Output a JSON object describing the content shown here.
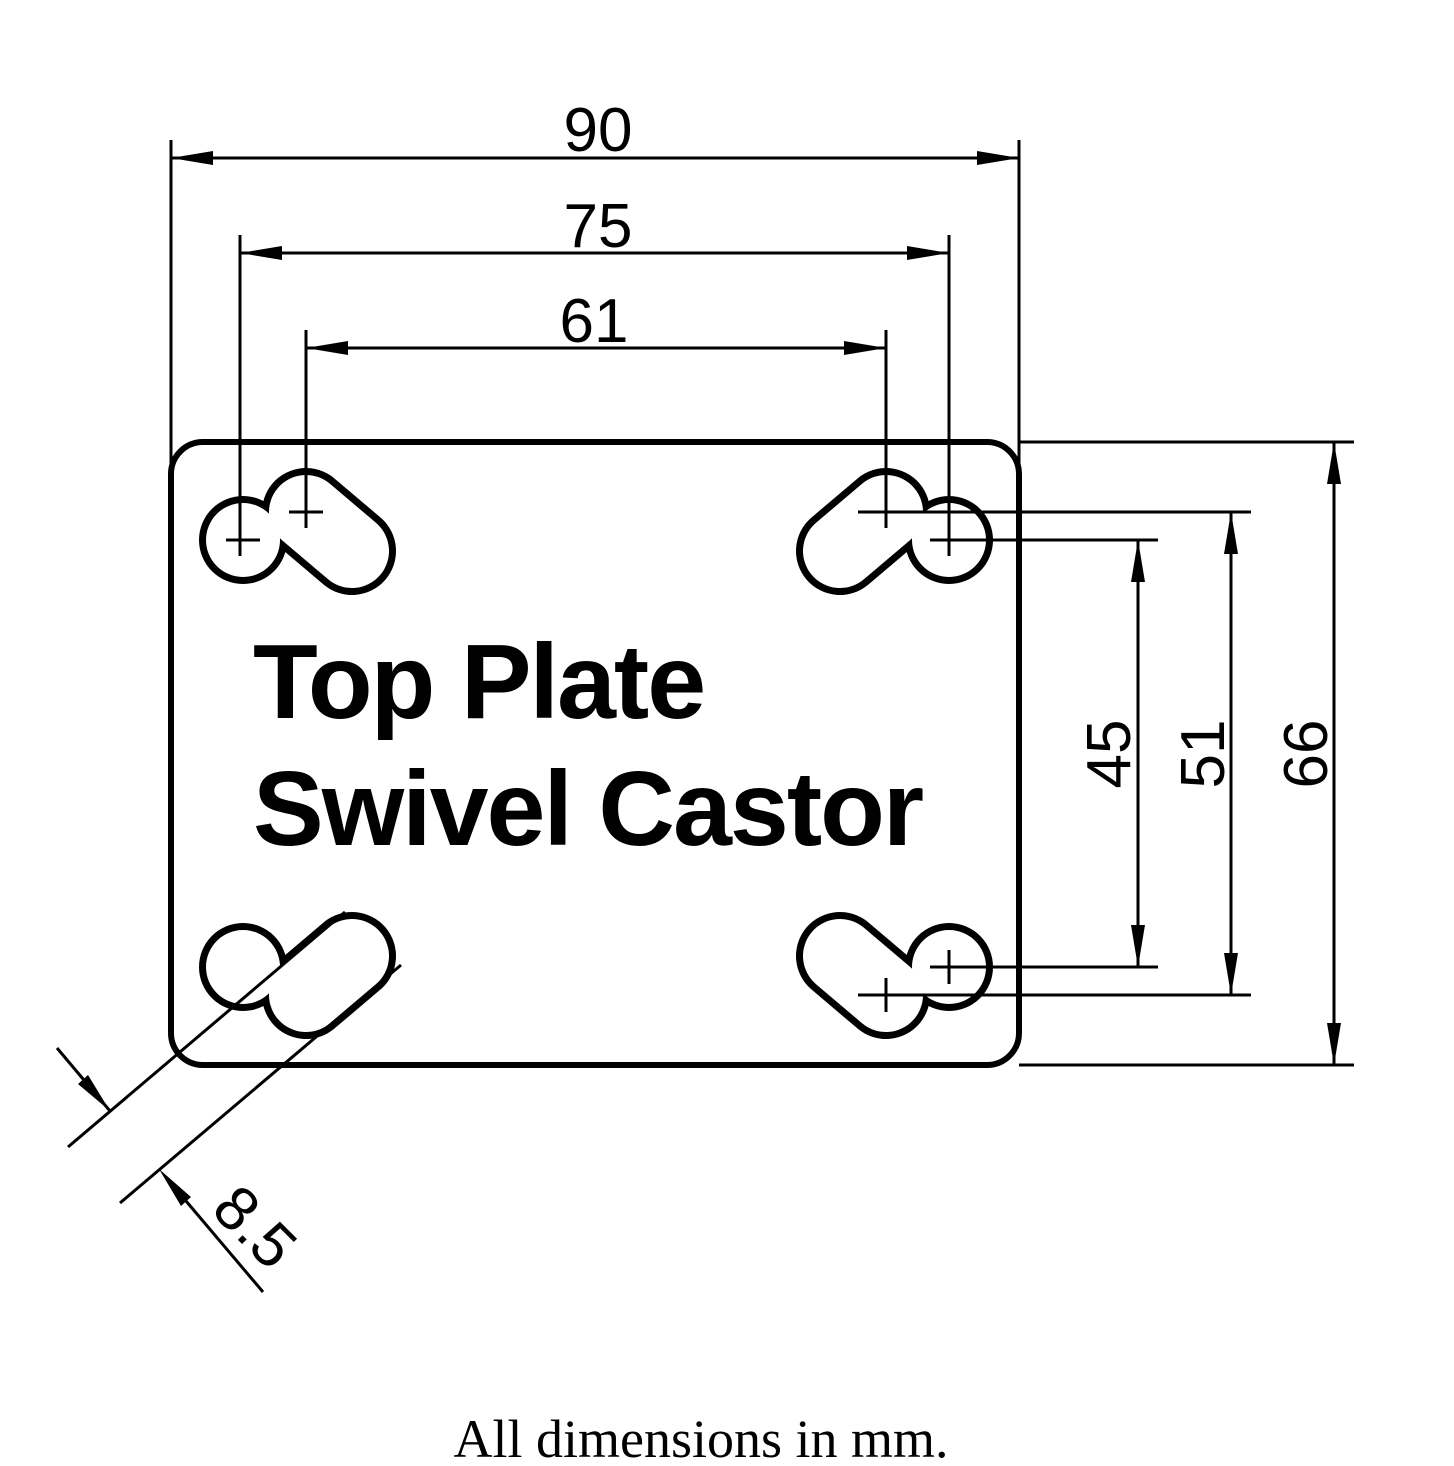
{
  "drawing": {
    "title_line1": "Top Plate",
    "title_line2": "Swivel Castor",
    "units_note": "All dimensions in mm.",
    "line_color": "#000000",
    "background_color": "#ffffff",
    "dimensions": {
      "plate_width": "90",
      "hole_pitch_75": "75",
      "hole_pitch_61": "61",
      "hole_pitch_45": "45",
      "hole_pitch_51": "51",
      "plate_height": "66",
      "slot_width": "8.5"
    }
  }
}
